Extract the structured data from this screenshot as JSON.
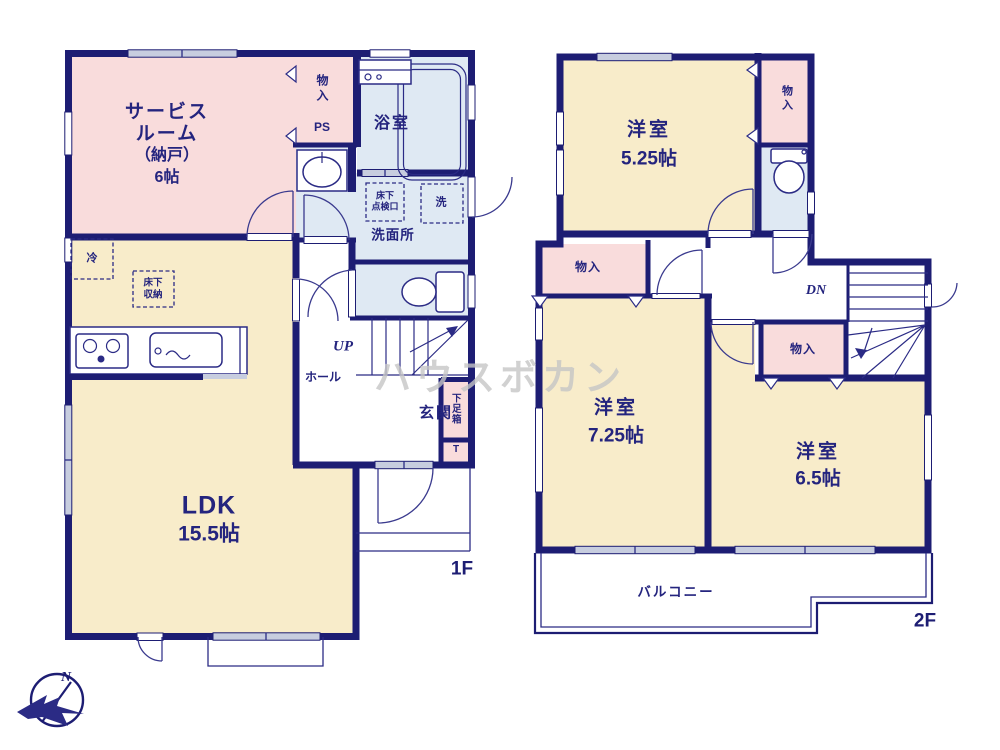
{
  "colors": {
    "wall": "#1d1d73",
    "text": "#24247e",
    "room_pink": "#f9dcdc",
    "room_cream": "#f8ecca",
    "room_blue": "#dfe9f3",
    "window_gray": "#c7cddf",
    "watermark_gray": "#c6c6c6"
  },
  "watermark": {
    "text": "ハウスボカン"
  },
  "compass": {
    "label": "N"
  },
  "floor1": {
    "label": "1F",
    "service_room": {
      "line1": "サービス",
      "line2": "ルーム",
      "line3": "（納戸）",
      "line4": "6帖"
    },
    "closet": "物入",
    "ps": "PS",
    "bath": "浴室",
    "hatch": {
      "line1": "床下",
      "line2": "点検口"
    },
    "laundry": "洗",
    "washroom": "洗面所",
    "fridge": "冷",
    "floor_storage": {
      "line1": "床下",
      "line2": "収納"
    },
    "up": "UP",
    "hall": "ホール",
    "entrance": "玄関",
    "shoe_box": "下足箱",
    "t": "T",
    "ldk": {
      "name": "LDK",
      "size": "15.5帖"
    }
  },
  "floor2": {
    "label": "2F",
    "room_525": {
      "name": "洋室",
      "size": "5.25帖"
    },
    "closet_top": "物入",
    "closet_left": "物入",
    "closet_mid": "物入",
    "dn": "DN",
    "room_725": {
      "name": "洋室",
      "size": "7.25帖"
    },
    "room_65": {
      "name": "洋室",
      "size": "6.5帖"
    },
    "balcony": "バルコニー"
  }
}
